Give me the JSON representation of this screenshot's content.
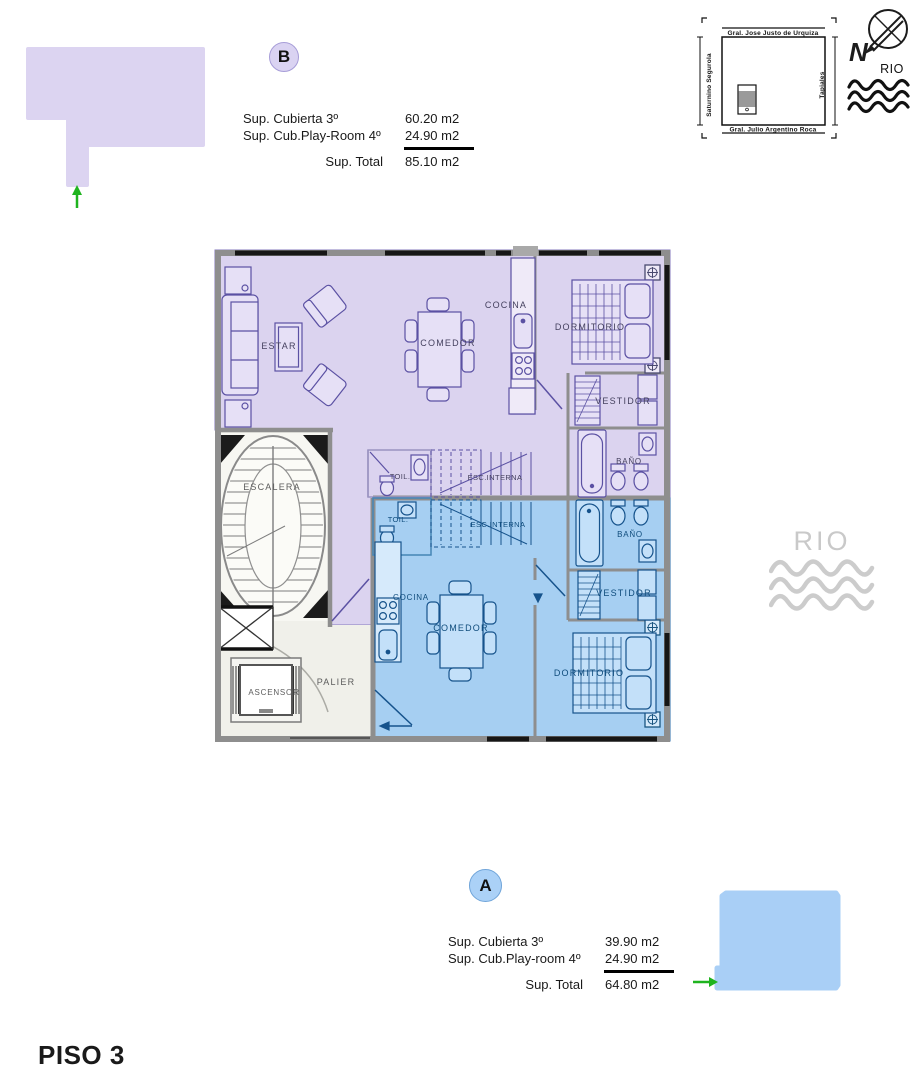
{
  "page_title": "PISO 3",
  "units": {
    "b": {
      "badge": "B",
      "rows": [
        {
          "label": "Sup. Cubierta 3º",
          "value": "60.20 m2"
        },
        {
          "label": "Sup. Cub.Play-Room 4º",
          "value": "24.90 m2"
        }
      ],
      "total_label": "Sup. Total",
      "total_value": "85.10 m2",
      "fill_color": "#DCD4F1"
    },
    "a": {
      "badge": "A",
      "rows": [
        {
          "label": "Sup. Cubierta 3º",
          "value": "39.90 m2"
        },
        {
          "label": "Sup. Cub.Play-room 4º",
          "value": "24.90 m2"
        }
      ],
      "total_label": "Sup. Total",
      "total_value": "64.80 m2",
      "fill_color": "#A9CFF6"
    }
  },
  "site_map": {
    "street_top": "Gral. Jose Justo de Urquiza",
    "street_left": "Saturnino Segurola",
    "street_right": "Tapiales",
    "street_bottom": "Gral. Julio Argentino Roca",
    "compass_north": "N",
    "river_label": "RIO"
  },
  "watermark": {
    "river_label": "RIO"
  },
  "plan": {
    "labels": {
      "estar": "ESTAR",
      "comedor_b": "COMEDOR",
      "cocina_b": "COCINA",
      "dormitorio_b": "DORMITORIO",
      "vestidor_b": "VESTIDOR",
      "bano_b": "BAÑO",
      "toil_b": "TOIL.",
      "esc_interna_b": "ESC.INTERNA",
      "toil_a": "TOIL.",
      "esc_interna_a": "ESC.INTERNA",
      "bano_a": "BAÑO",
      "cocina_a": "COCINA",
      "comedor_a": "COMEDOR",
      "vestidor_a": "VESTIDOR",
      "dormitorio_a": "DORMITORIO",
      "escalera": "ESCALERA",
      "ascensor": "ASCENSOR",
      "palier": "PALIER"
    }
  }
}
